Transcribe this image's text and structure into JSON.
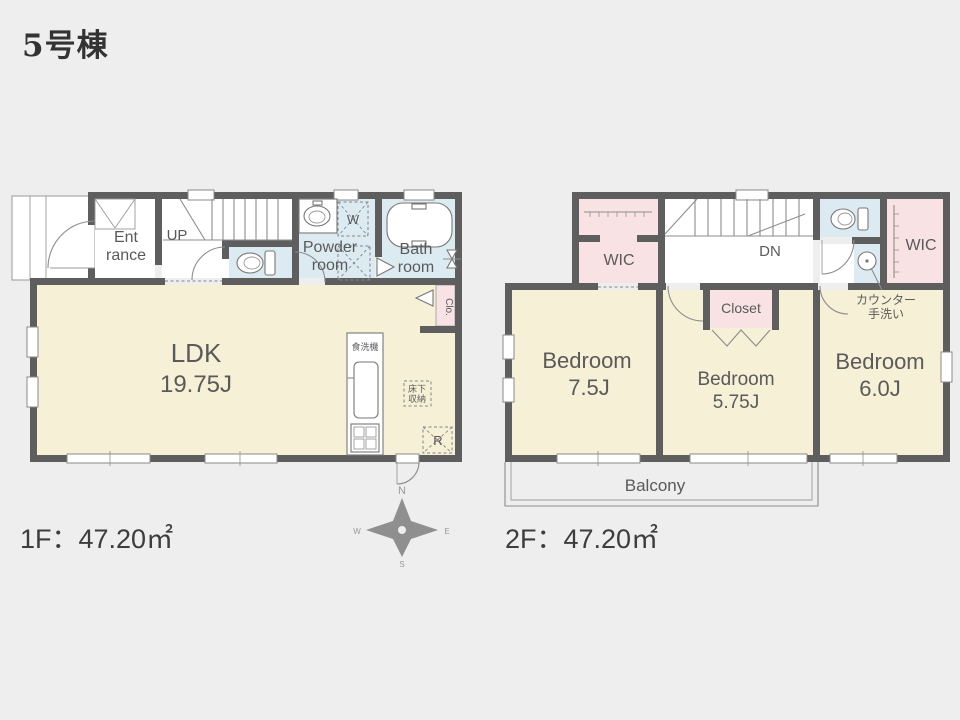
{
  "title": "5号棟",
  "colors": {
    "background": "#eeeeee",
    "wall": "#5e5e5e",
    "room_cream": "#f6f0d6",
    "room_blue": "#dcebf1",
    "room_pink": "#f8e2e4",
    "accent_text": "#5a5a5a"
  },
  "floor1": {
    "area_label": "1F：47.20㎡",
    "labels": {
      "entrance_line1": "Ent",
      "entrance_line2": "rance",
      "stairs_up": "UP",
      "powder_line1": "Powder",
      "powder_line2": "room",
      "bath_line1": "Bath",
      "bath_line2": "room",
      "washer": "W",
      "ldk_line1": "LDK",
      "ldk_line2": "19.75J",
      "dishwasher": "食洗機",
      "underfloor_line1": "床下",
      "underfloor_line2": "収納",
      "refrigerator": "R",
      "closet": "Clo."
    }
  },
  "floor2": {
    "area_label": "2F：47.20㎡",
    "labels": {
      "wic_left": "WIC",
      "stairs_down": "DN",
      "wic_right": "WIC",
      "counter_line1": "カウンター",
      "counter_line2": "手洗い",
      "closet": "Closet",
      "bedroom1_line1": "Bedroom",
      "bedroom1_line2": "7.5J",
      "bedroom2_line1": "Bedroom",
      "bedroom2_line2": "5.75J",
      "bedroom3_line1": "Bedroom",
      "bedroom3_line2": "6.0J",
      "balcony": "Balcony"
    }
  },
  "compass": {
    "north": "N",
    "east": "E",
    "south": "S",
    "west": "W"
  }
}
